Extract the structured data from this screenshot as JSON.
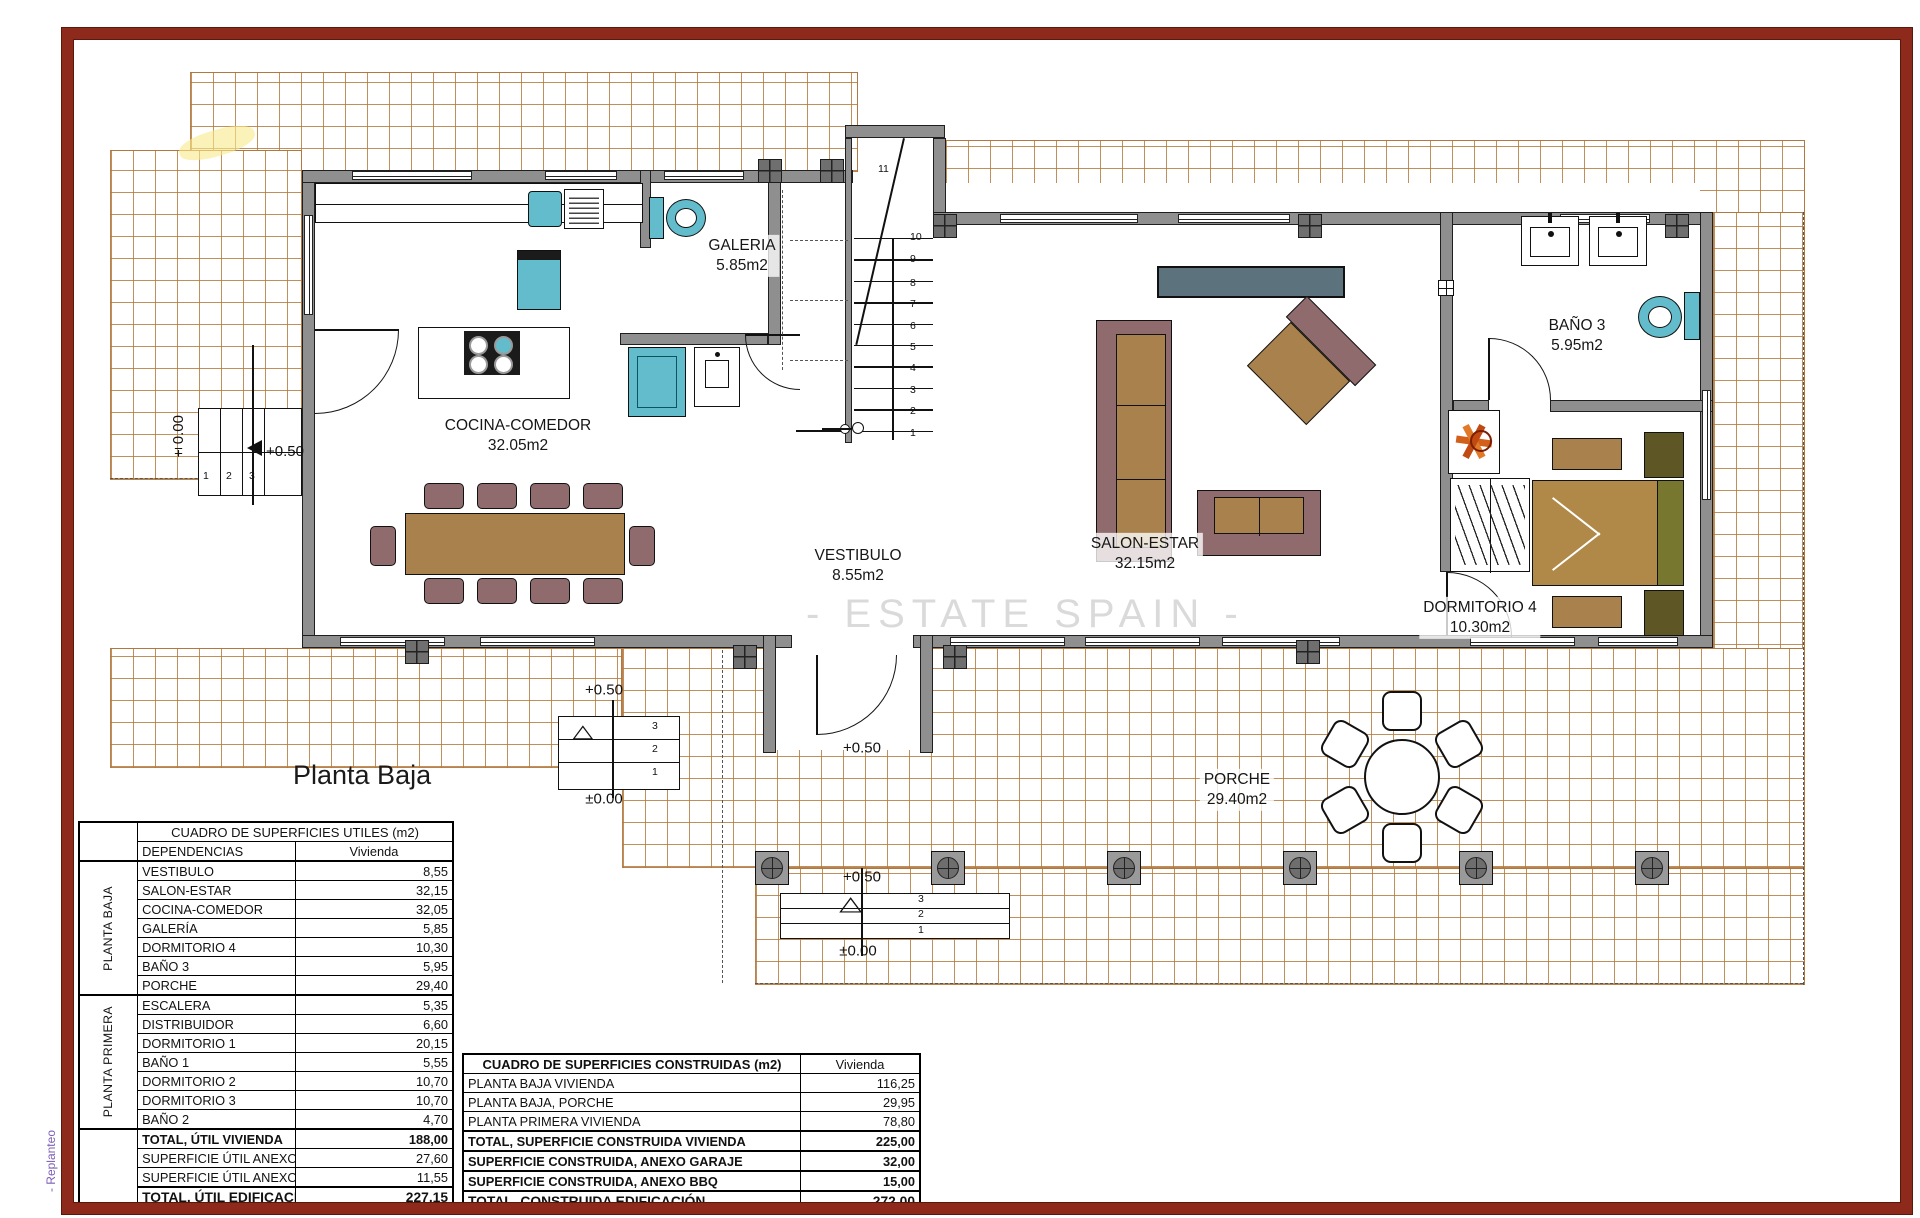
{
  "page": {
    "plan_title": "Planta Baja",
    "watermark": "- ESTATE SPAIN -",
    "margin_note": "- Replanteo"
  },
  "icons": {
    "up_arrow": "△"
  },
  "plan": {
    "rooms": {
      "galeria": {
        "name": "GALERIA",
        "area": "5.85m2"
      },
      "cocina": {
        "name": "COCINA-COMEDOR",
        "area": "32.05m2"
      },
      "vestibulo": {
        "name": "VESTIBULO",
        "area": "8.55m2"
      },
      "salon": {
        "name": "SALON-ESTAR",
        "area": "32.15m2"
      },
      "bano3": {
        "name": "BAÑO 3",
        "area": "5.95m2"
      },
      "dormitorio4": {
        "name": "DORMITORIO 4",
        "area": "10.30m2"
      },
      "porche": {
        "name": "PORCHE",
        "area": "29.40m2"
      }
    },
    "stair": {
      "numbers": [
        "1",
        "2",
        "3",
        "4",
        "5",
        "6",
        "7",
        "8",
        "9",
        "10"
      ],
      "top_number": "11"
    },
    "markers": {
      "west": {
        "zero": "±0.00",
        "half": "+0.50",
        "steps": [
          "1",
          "2",
          "3"
        ]
      },
      "south_left": {
        "half": "+0.50",
        "zero": "±0.00",
        "steps": [
          "3",
          "2",
          "1"
        ]
      },
      "entrance": {
        "half": "+0.50"
      },
      "south_center": {
        "half": "+0.50",
        "zero": "±0.00",
        "steps": [
          "3",
          "2",
          "1"
        ]
      }
    }
  },
  "tables": {
    "utiles": {
      "title": "CUADRO DE SUPERFICIES UTILES (m2)",
      "col_dependencias": "DEPENDENCIAS",
      "col_vivienda": "Vivienda",
      "groups": [
        {
          "label": "PLANTA BAJA",
          "rows": [
            {
              "name": "VESTIBULO",
              "value": "8,55"
            },
            {
              "name": "SALON-ESTAR",
              "value": "32,15"
            },
            {
              "name": "COCINA-COMEDOR",
              "value": "32,05"
            },
            {
              "name": "GALERÍA",
              "value": "5,85"
            },
            {
              "name": "DORMITORIO 4",
              "value": "10,30"
            },
            {
              "name": "BAÑO 3",
              "value": "5,95"
            },
            {
              "name": "PORCHE",
              "value": "29,40"
            }
          ]
        },
        {
          "label": "PLANTA PRIMERA",
          "rows": [
            {
              "name": "ESCALERA",
              "value": "5,35"
            },
            {
              "name": "DISTRIBUIDOR",
              "value": "6,60"
            },
            {
              "name": "DORMITORIO 1",
              "value": "20,15"
            },
            {
              "name": "BAÑO 1",
              "value": "5,55"
            },
            {
              "name": "DORMITORIO 2",
              "value": "10,70"
            },
            {
              "name": "DORMITORIO 3",
              "value": "10,70"
            },
            {
              "name": "BAÑO 2",
              "value": "4,70"
            }
          ]
        }
      ],
      "totals": [
        {
          "name": "TOTAL, ÚTIL VIVIENDA",
          "value": "188,00",
          "bold": true,
          "final": false
        },
        {
          "name": "SUPERFICIE ÚTIL ANEXO GARAJE",
          "value": "27,60",
          "bold": false,
          "final": false
        },
        {
          "name": "SUPERFICIE ÚTIL ANEXO BBQ",
          "value": "11,55",
          "bold": false,
          "final": false
        },
        {
          "name": "TOTAL, ÚTIL EDIFICACION",
          "value": "227,15",
          "bold": true,
          "final": true
        }
      ]
    },
    "construidas": {
      "title": "CUADRO DE SUPERFICIES CONSTRUIDAS (m2)",
      "col_vivienda": "Vivienda",
      "rows": [
        {
          "name": "PLANTA BAJA VIVIENDA",
          "value": "116,25"
        },
        {
          "name": "PLANTA BAJA, PORCHE",
          "value": "29,95"
        },
        {
          "name": "PLANTA PRIMERA VIVIENDA",
          "value": "78,80"
        }
      ],
      "totals": [
        {
          "name": "TOTAL, SUPERFICIE CONSTRUIDA VIVIENDA",
          "value": "225,00",
          "final": false
        },
        {
          "name": "SUPERFICIE CONSTRUIDA, ANEXO GARAJE",
          "value": "32,00",
          "final": false
        },
        {
          "name": "SUPERFICIE CONSTRUIDA, ANEXO BBQ",
          "value": "15,00",
          "final": false
        },
        {
          "name": "TOTAL, CONSTRUIDA EDIFICACIÓN",
          "value": "272,00",
          "final": true
        }
      ]
    }
  }
}
